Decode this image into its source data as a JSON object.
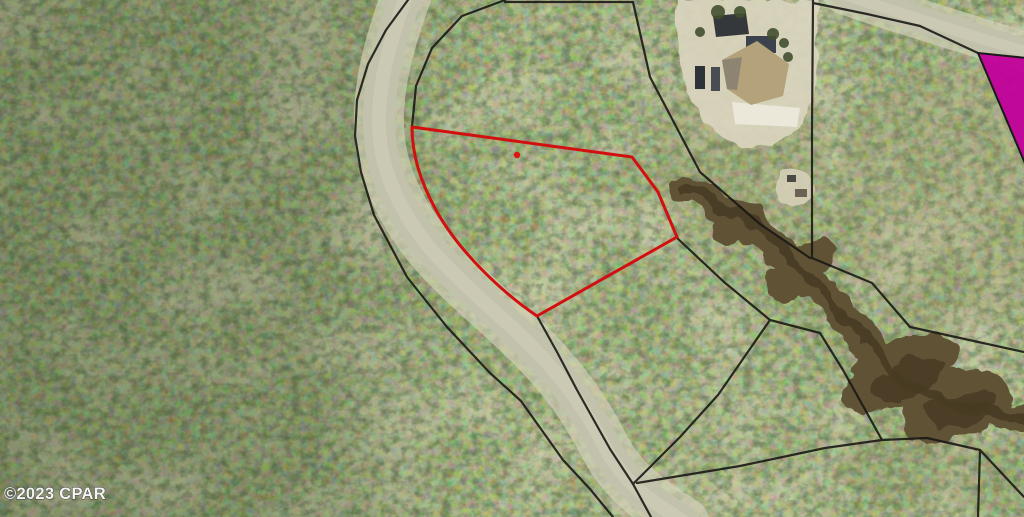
{
  "meta": {
    "watermark": "©2023 CPAR",
    "description": "Aerial parcel map with subject lot outlined in red"
  },
  "colors": {
    "subject_outline": "#d21010",
    "marker_dot": "#e01212",
    "boundary_line": "#1b1916",
    "highlight_fill": "#c2039b",
    "highlight_stroke": "#141414",
    "road_fill": "#c2c1ab",
    "road_shoulder": "#d6d3bc",
    "road_highlight": "#d0cfbb",
    "creek_fill": "#615236",
    "creek_dark": "#463a24",
    "sand_fill": "#dbd5bf",
    "driveway_fill": "#d6d0b8",
    "patio_fill": "#ebe7d9",
    "roof_main": "#b3a27a",
    "roof_facet": "#8e8472",
    "roof_garage": "#34383a",
    "lanai_fill": "#3c434c",
    "vehicle_dark": "#2e3338",
    "vehicle_mid": "#474d52",
    "tree_dark": "#42502e",
    "shed_dark": "#4a4a42",
    "shed_mid": "#6b6154",
    "watermark_fill": "#f4f4f4",
    "watermark_stroke": "#3f3f3f"
  },
  "subject_parcel": {
    "label": "subject lot outline",
    "outline_path": "M 412,127 L 632,157 L 658,192 L 677,237 L 537,316 C 503,293 459,252 436,210 C 421,183 412,156 412,127 Z",
    "stroke_width": 3,
    "marker": {
      "cx": 517,
      "cy": 155,
      "r": 3.2
    }
  },
  "highlight_parcel": {
    "label": "magenta highlighted parcel",
    "points": "978,53 1027,58 1027,168"
  },
  "boundary_lines": [
    {
      "name": "road-west-line",
      "points": "408,0 386,30 368,64 357,100 355,136 361,172 374,215 407,277 447,327 490,373 521,401 563,460 590,489 613,517"
    },
    {
      "name": "road-east-upper",
      "points": "505,0 462,16 432,48 416,86 412,127"
    },
    {
      "name": "top-edge-line",
      "points": "505,2 633,2"
    },
    {
      "name": "house-west-diagonal",
      "points": "633,2 650,77 700,172 760,224 810,258"
    },
    {
      "name": "house-west-vertical",
      "points": "813,0 812,130 812,258"
    },
    {
      "name": "topright-road-south",
      "points": "813,3 867,14 920,26 978,53"
    },
    {
      "name": "creek-north-line",
      "points": "812,258 872,283 910,327 1024,352"
    },
    {
      "name": "creek-south-line",
      "points": "676,237 724,282 770,320 820,333 843,370 882,440 927,438 980,450 978,517"
    },
    {
      "name": "road-east-lower",
      "points": "537,316 557,352 577,390 610,449 633,484 651,517"
    },
    {
      "name": "creek-west-diagonal",
      "points": "633,484 680,437 718,395 770,320"
    },
    {
      "name": "south-connector",
      "points": "637,483 740,466 825,448 882,440"
    },
    {
      "name": "corner-branch",
      "points": "980,450 1024,497"
    }
  ],
  "roads": {
    "main": {
      "center_path": "M 409,-12 C 390,40 378,82 379,126 C 380,168 398,208 428,246 C 462,286 505,318 537,352 C 568,384 588,414 606,449 C 624,483 650,500 684,522",
      "width": 32,
      "shoulder_width": 50,
      "highlight_width": 14
    },
    "top_right": {
      "center_path": "M 843,-6 C 900,14 955,30 1032,54",
      "width": 26,
      "shoulder_width": 40,
      "highlight_width": 11
    }
  },
  "creek": {
    "center_path": "M 688,188 C 732,206 768,240 806,274 C 844,308 862,346 900,376 C 936,404 980,412 1028,418",
    "width": 28,
    "dark_width": 10,
    "blobs": [
      {
        "cx": 735,
        "cy": 225,
        "rx": 30,
        "ry": 16,
        "transform": "rotate(-42 735 225)"
      },
      {
        "cx": 800,
        "cy": 272,
        "rx": 40,
        "ry": 20,
        "transform": "rotate(-38 800 272)"
      },
      {
        "cx": 900,
        "cy": 372,
        "rx": 62,
        "ry": 30,
        "transform": "rotate(-26 900 372)"
      },
      {
        "cx": 955,
        "cy": 405,
        "rx": 58,
        "ry": 34,
        "transform": "rotate(-12 955 405)"
      }
    ],
    "dark_cores": [
      {
        "cx": 905,
        "cy": 380,
        "rx": 40,
        "ry": 16,
        "transform": "rotate(-24 905 380)"
      },
      {
        "cx": 960,
        "cy": 410,
        "rx": 36,
        "ry": 18,
        "transform": "rotate(-10 960 410)"
      }
    ]
  },
  "house": {
    "yard_path": "M 676,0 L 818,0 L 816,90 C 808,126 780,150 752,148 C 718,145 690,112 681,70 C 677,45 675,20 676,0 Z",
    "driveway_path": "M 702,0 L 718,0 C 716,40 716,68 722,95 L 707,98 C 700,62 700,28 702,0 Z",
    "patio_path": "M 732,102 L 800,108 L 797,127 L 735,124 Z",
    "garage_points": "713,16 746,13 749,34 716,37",
    "lanai": {
      "x": 746,
      "y": 36,
      "w": 30,
      "h": 17
    },
    "roof_path": "M 722,60 L 757,41 L 789,64 L 783,96 L 751,105 L 727,89 Z",
    "roof_facet_path": "M 722,60 L 742,57 L 737,90 L 727,89 Z",
    "vehicles": [
      {
        "x": 695,
        "y": 66,
        "w": 10,
        "h": 23
      },
      {
        "x": 711,
        "y": 67,
        "w": 9,
        "h": 24
      }
    ],
    "trees": [
      {
        "cx": 718,
        "cy": 12,
        "r": 7
      },
      {
        "cx": 740,
        "cy": 12,
        "r": 6
      },
      {
        "cx": 773,
        "cy": 34,
        "r": 6
      },
      {
        "cx": 784,
        "cy": 43,
        "r": 5
      },
      {
        "cx": 788,
        "cy": 57,
        "r": 5
      },
      {
        "cx": 700,
        "cy": 32,
        "r": 5
      }
    ]
  },
  "clearing": {
    "ground_path": "M 779,170 C 800,166 813,175 813,190 C 813,203 800,209 789,207 C 779,205 773,196 774,186 Z",
    "sheds": [
      {
        "x": 787,
        "y": 175,
        "w": 9,
        "h": 7
      },
      {
        "x": 795,
        "y": 189,
        "w": 12,
        "h": 8
      }
    ]
  },
  "watermark": {
    "x": 4,
    "y": 499,
    "font_size": 16.5
  }
}
